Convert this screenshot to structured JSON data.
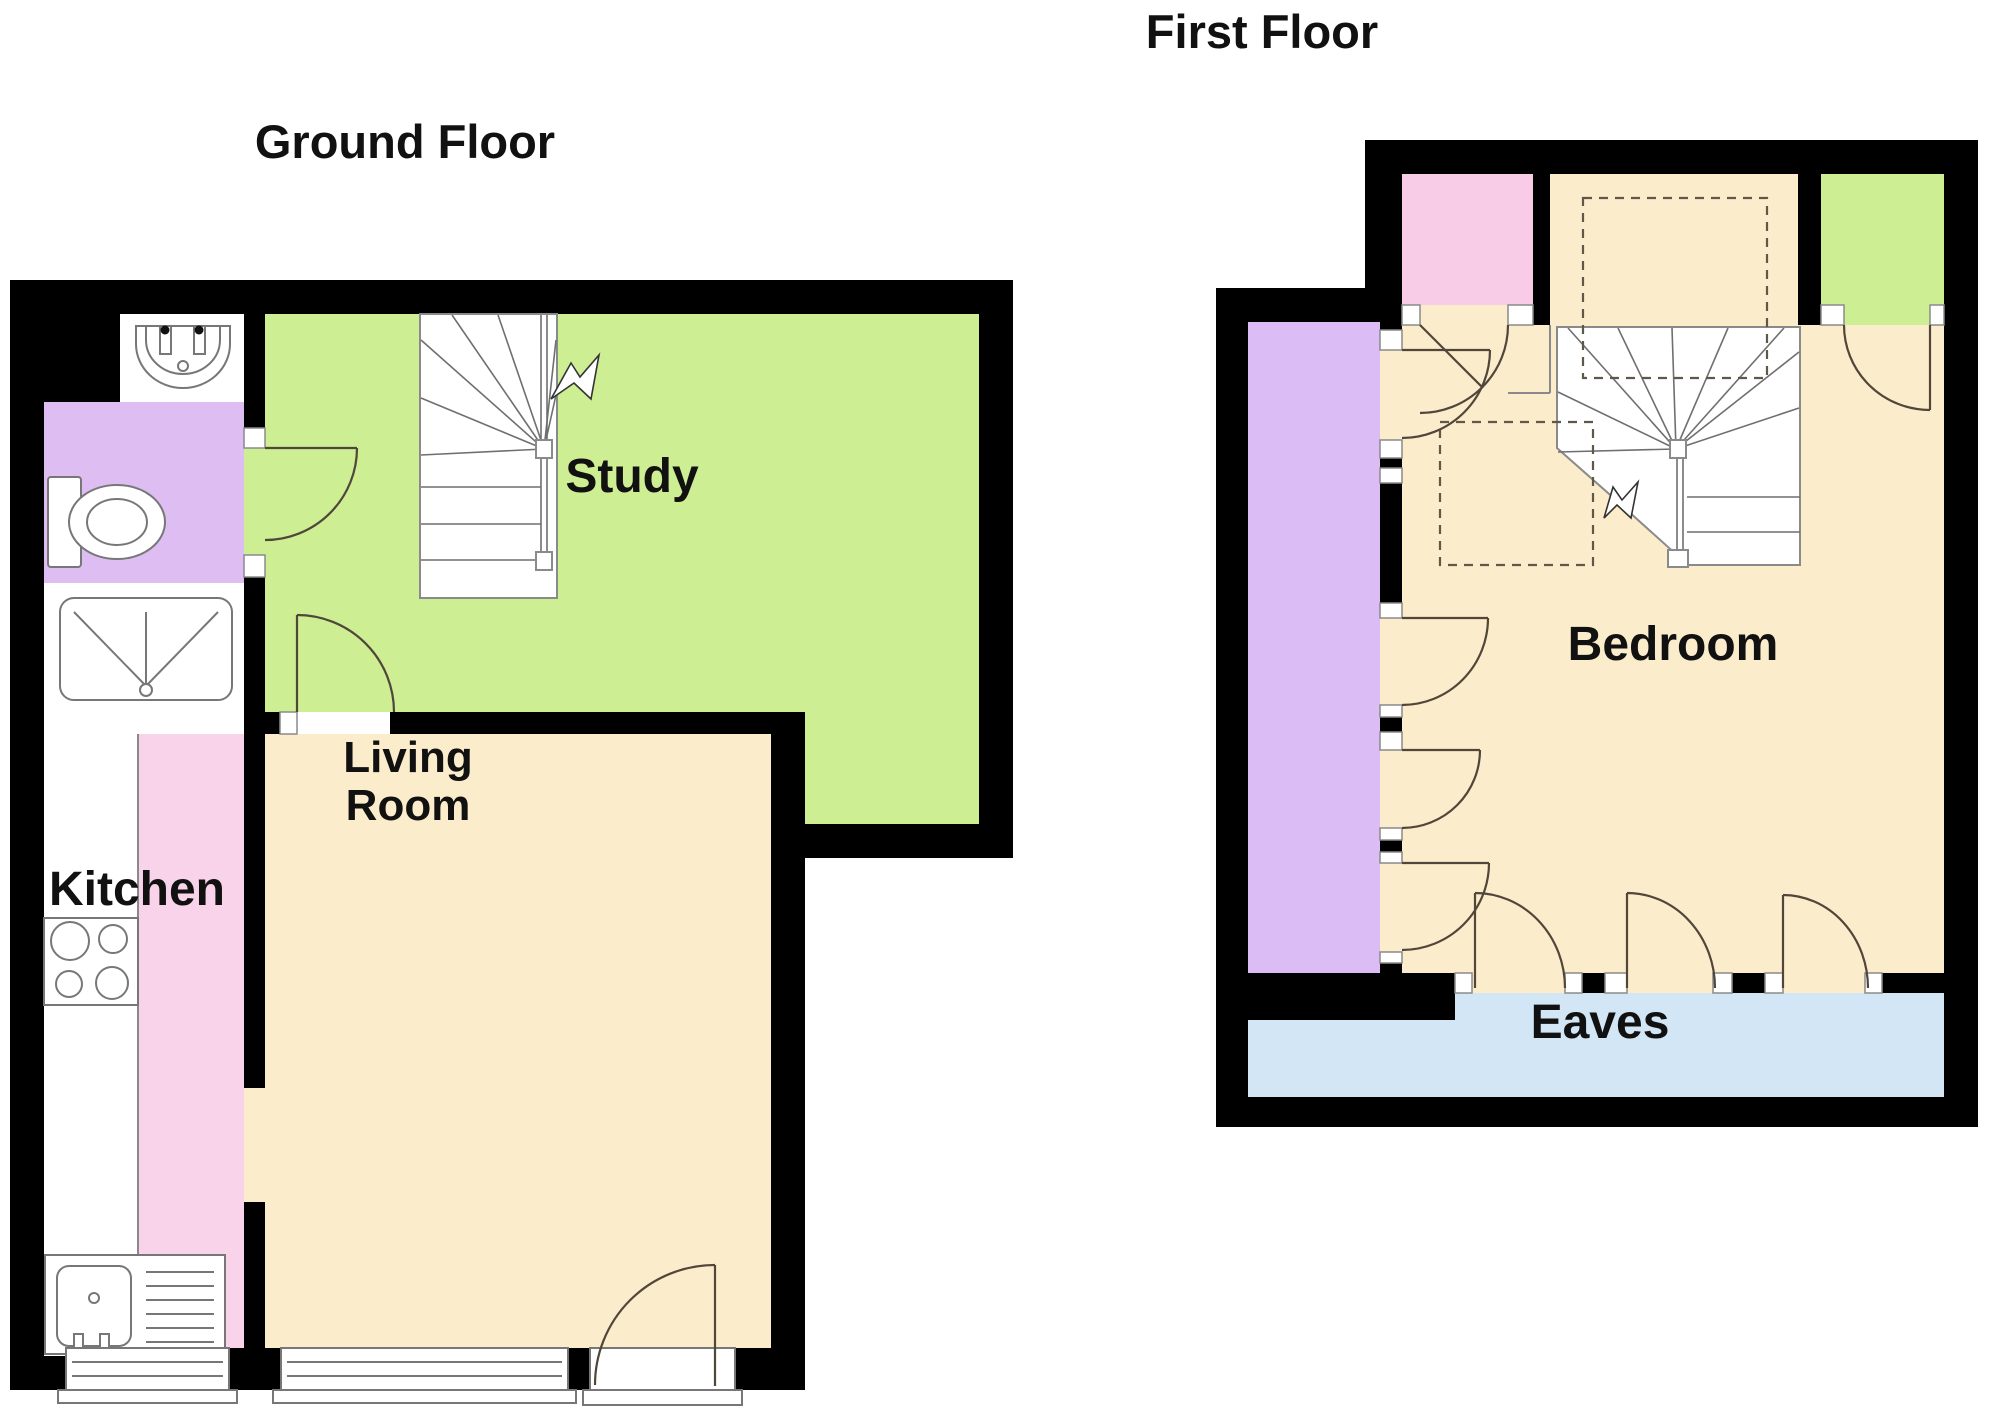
{
  "titles": {
    "ground_floor": "Ground Floor",
    "first_floor": "First Floor"
  },
  "labels": {
    "study": "Study",
    "kitchen": "Kitchen",
    "living_line1": "Living",
    "living_line2": "Room",
    "bedroom": "Bedroom",
    "eaves": "Eaves"
  },
  "colors": {
    "background": "#ffffff",
    "wall": "#000000",
    "study_green": "#cdee92",
    "living_beige": "#fbeccb",
    "kitchen_pink": "#f9d3e9",
    "bathroom_purple": "#ddbdf2",
    "first_purple": "#dcbcf5",
    "first_pink": "#f8cce6",
    "first_green": "#cdee92",
    "eaves_blue": "#d2e6f5",
    "fixture_white": "#ffffff",
    "door_line": "#50463a",
    "dash_line": "#5f5748",
    "text": "#111111"
  },
  "icons": {
    "basin": "sink-icon",
    "toilet": "toilet-icon",
    "shower": "shower-tray-icon",
    "hob": "hob-icon",
    "kitchen_sink": "kitchen-sink-icon",
    "stairs": "staircase-icon",
    "window": "window-icon",
    "door": "door-arc-icon",
    "up_arrow": "stair-direction-arrow-icon",
    "bed": "bed-dashed-outline"
  }
}
